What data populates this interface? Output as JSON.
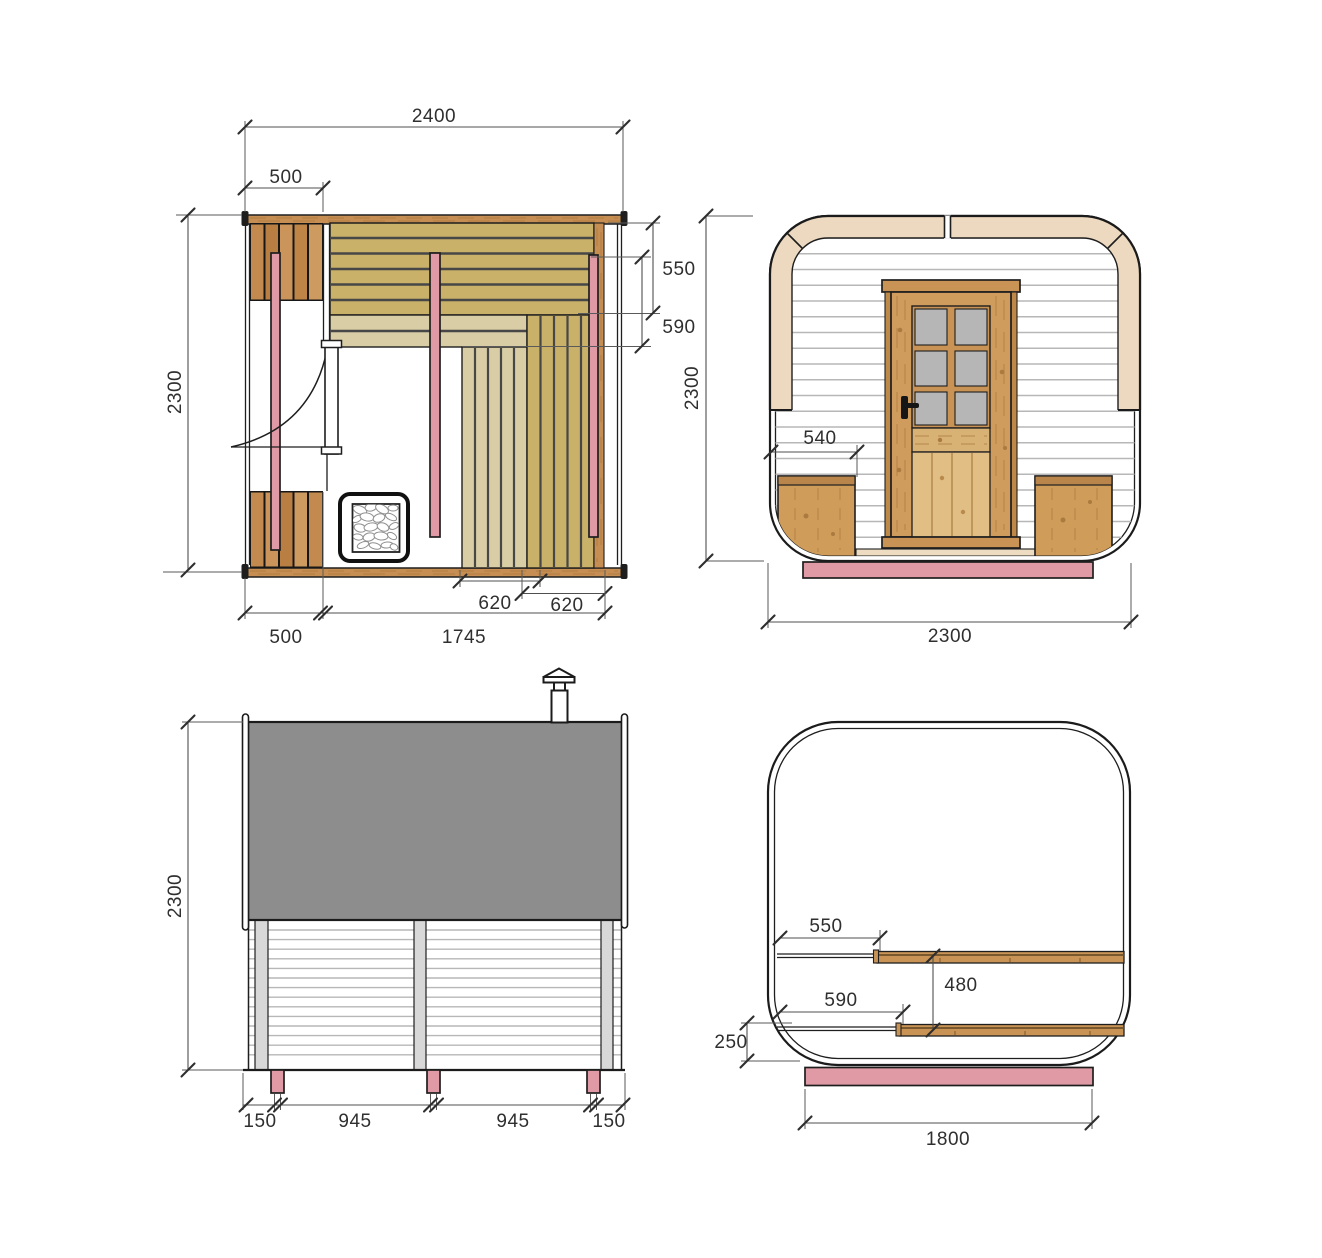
{
  "drawing_kind": "sauna-technical-drawing",
  "views": {
    "floor_plan": {
      "dims": {
        "overall_width": "2400",
        "porch_width_top": "500",
        "upper_bench_depth": "550",
        "lower_bench_depth": "590",
        "overall_depth": "2300",
        "bench_segment_a": "620",
        "bench_segment_b": "620",
        "porch_width_bottom": "500",
        "interior_width": "1745"
      }
    },
    "front_view": {
      "dims": {
        "overall_height": "2300",
        "corner_bench_width": "540",
        "overall_width": "2300"
      }
    },
    "side_view": {
      "dims": {
        "overall_height": "2300",
        "foot_inset_left": "150",
        "foot_spacing_a": "945",
        "foot_spacing_b": "945",
        "foot_inset_right": "150"
      }
    },
    "cross_section": {
      "dims": {
        "upper_bench_offset": "550",
        "lower_bench_offset": "590",
        "bench_level_gap": "480",
        "base_clearance": "250",
        "base_width": "1800"
      }
    }
  },
  "colors": {
    "wood": "#c68e52",
    "wood_light": "#e0be84",
    "bench_olive": "#c9b169",
    "bench_beige": "#d9cda6",
    "accent_pink": "#e09aa6",
    "frame_beige": "#ecd9c0",
    "roof_gray": "#8d8d8d",
    "post_gray": "#d8d8d8",
    "glass_gray": "#b6b6b6",
    "line": "#1e1e1e",
    "dim_line": "#4f4f4f"
  }
}
